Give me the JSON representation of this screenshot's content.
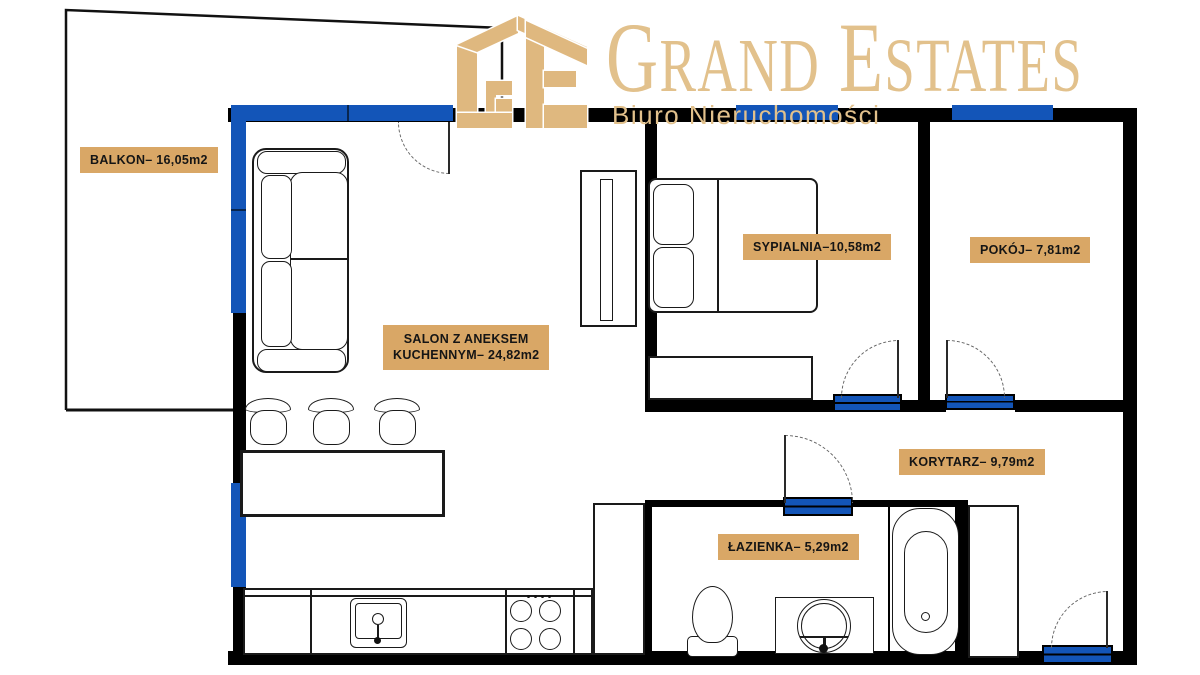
{
  "brand": {
    "monogram": "GE",
    "initial1": "G",
    "rest1": "RAND",
    "initial2": "E",
    "rest2": "STATES",
    "tagline": "Biuro Nieruchomości"
  },
  "rooms": {
    "balkon": {
      "name": "BALKON",
      "area_m2": "16,05",
      "label": "BALKON– 16,05m2"
    },
    "salon": {
      "name": "SALON Z ANEKSEM KUCHENNYM",
      "area_m2": "24,82",
      "line1": "SALON Z ANEKSEM",
      "line2": "KUCHENNYM– 24,82m2"
    },
    "sypialnia": {
      "name": "SYPIALNIA",
      "area_m2": "10,58",
      "label": "SYPIALNIA–10,58m2"
    },
    "pokoj": {
      "name": "POKÓJ",
      "area_m2": "7,81",
      "label": "POKÓJ– 7,81m2"
    },
    "korytarz": {
      "name": "KORYTARZ",
      "area_m2": "9,79",
      "label": "KORYTARZ– 9,79m2"
    },
    "lazienka": {
      "name": "ŁAZIENKA",
      "area_m2": "5,29",
      "label": "ŁAZIENKA– 5,29m2"
    }
  },
  "colors": {
    "wall": "#000000",
    "window_blue": "#1355b8",
    "label_background": "#d9a766",
    "label_text": "#151515",
    "brand_gold": "#e2c18c"
  }
}
